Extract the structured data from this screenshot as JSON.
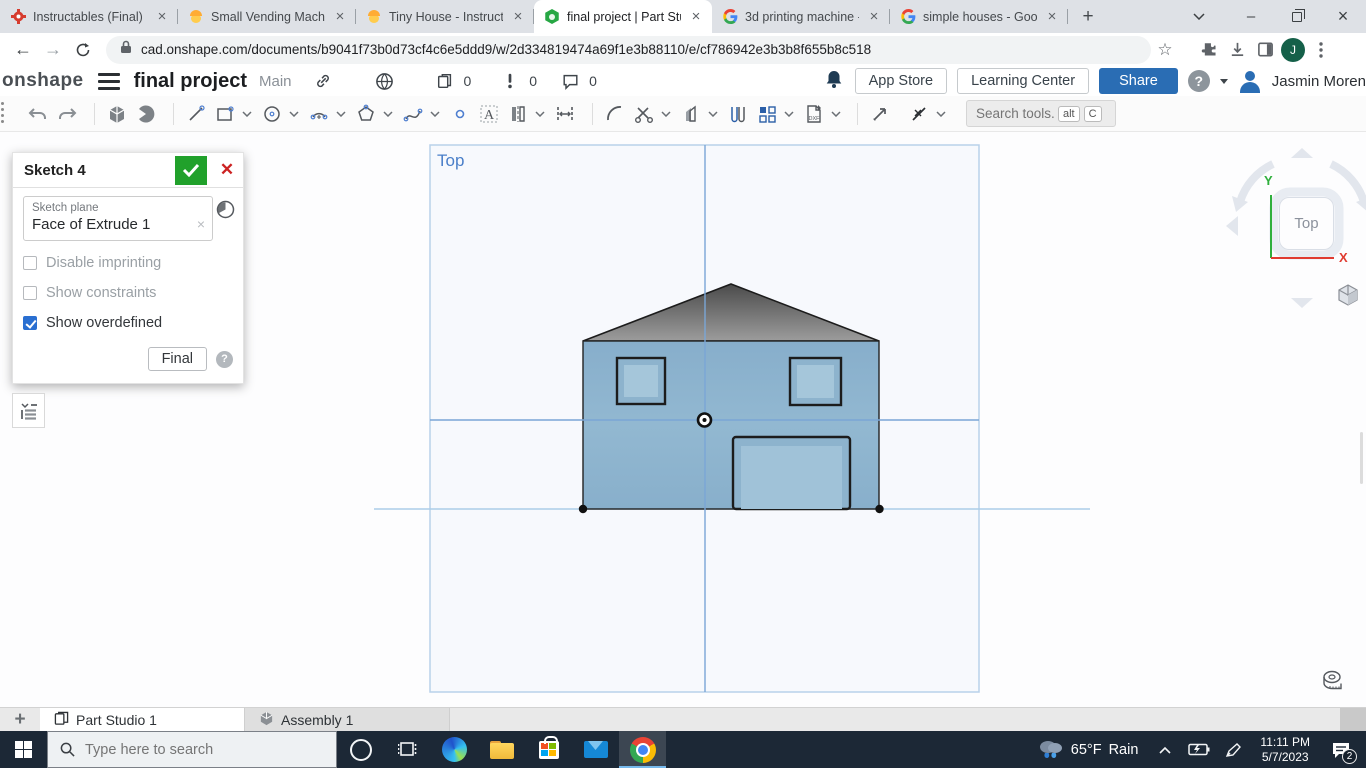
{
  "browser": {
    "tabs": [
      {
        "title": "Instructables (Final)",
        "icon": "instructables",
        "active": false
      },
      {
        "title": "Small Vending Machin",
        "icon": "worker-emoji",
        "active": false
      },
      {
        "title": "Tiny House - Instructa",
        "icon": "worker-emoji",
        "active": false
      },
      {
        "title": "final project | Part Stu",
        "icon": "onshape",
        "active": true
      },
      {
        "title": "3d printing machine -",
        "icon": "google",
        "active": false
      },
      {
        "title": "simple houses - Goog",
        "icon": "google",
        "active": false
      }
    ],
    "new_tab_label": "+",
    "close_label": "×",
    "minimize_label": "–",
    "url": "cad.onshape.com/documents/b9041f73b0d73cf4c6e5ddd9/w/2d334819474a69f1e3b88110/e/cf786942e3b3b8f655b8c518",
    "profile_initial": "J",
    "back_label": "←",
    "forward_label": "→",
    "bookmark_star": "☆"
  },
  "onshape_header": {
    "logo_text": "onshape",
    "doc_title": "final project",
    "branch": "Main",
    "versions_count": "0",
    "alerts_count": "0",
    "comments_count": "0",
    "app_store_label": "App Store",
    "learning_center_label": "Learning Center",
    "share_label": "Share",
    "help_label": "?",
    "user_name": "Jasmin Moren"
  },
  "toolbar": {
    "search_placeholder": "Search tools...",
    "shortcut_alt": "alt",
    "shortcut_key": "C",
    "icons": [
      "undo",
      "redo",
      "extrude",
      "revolve",
      "line",
      "corner-rectangle",
      "center-point-circle",
      "arc",
      "polygon",
      "spline",
      "point",
      "text",
      "mirror",
      "dimension",
      "fillet",
      "trim",
      "offset",
      "slot",
      "linear-pattern",
      "dxf-import",
      "measure",
      "construction"
    ]
  },
  "sketch_dialog": {
    "title": "Sketch 4",
    "confirm": "✓",
    "cancel": "✕",
    "plane_label": "Sketch plane",
    "plane_value": "Face of Extrude 1",
    "clear_label": "×",
    "checkboxes": [
      {
        "label": "Disable imprinting",
        "checked": false
      },
      {
        "label": "Show constraints",
        "checked": false
      },
      {
        "label": "Show overdefined",
        "checked": true
      }
    ],
    "final_button_label": "Final",
    "help_label": "?"
  },
  "canvas": {
    "view_orientation_label": "Top",
    "sketch_entities": {
      "house_body_color": "#8db3cd",
      "window_fill_color": "#a5c6da",
      "roof_gradient": [
        "#4b4b4b",
        "#9c9c9c"
      ],
      "sketch_axis_color": "#7aa6d6",
      "plane_border_color": "#b9d2ea",
      "construction_line_color": "#abcde8"
    }
  },
  "view_cube": {
    "face_label": "Top",
    "axis_x_label": "X",
    "axis_y_label": "Y",
    "axis_x_color": "#e03c31",
    "axis_y_color": "#2faf3c"
  },
  "bottom_bar": {
    "add_tab_label": "+",
    "tabs": [
      {
        "label": "Part Studio 1",
        "active": true
      },
      {
        "label": "Assembly 1",
        "active": false
      }
    ]
  },
  "taskbar": {
    "search_placeholder": "Type here to search",
    "weather_temp": "65°F",
    "weather_condition": "Rain",
    "time": "11:11 PM",
    "date": "5/7/2023",
    "notification_count": "2"
  }
}
